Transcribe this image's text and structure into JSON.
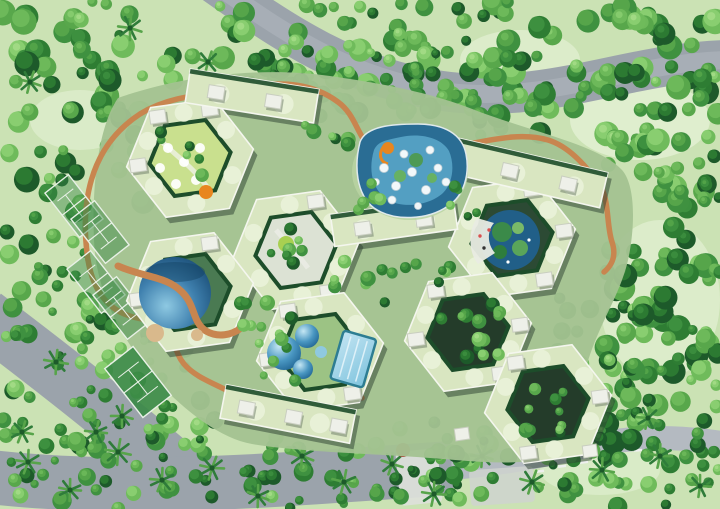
{
  "meta": {
    "description": "Aerial master-plan rendering of a hexagonal honeycomb residential complex surrounded by forest, roads, pools and tennis courts",
    "canvas": {
      "width": 720,
      "height": 509
    }
  },
  "palette": {
    "grass": "#cbe2b4",
    "glade": "#e7f3d9",
    "road": "#9ba3ab",
    "road_light": "#b4bac1",
    "plaza": "#dde1da",
    "plaza2": "#cfd4cf",
    "marking": "#eef0ee",
    "complex_ground": "#a3c291",
    "roof": "#d9e6c1",
    "roof_circle": "#e9f1d8",
    "roof_edge": "#f4f6ee",
    "box_white": "#eef0e9",
    "hedge": "#1d4d2a",
    "bldg_shadow": "#2a3e2f",
    "courtyard_dark": "#243c2a",
    "path_orange": "#c8854f",
    "deck_tan": "#d9b98c",
    "waterpark": "#2a6d94",
    "splash": "#5aa8ca",
    "slide_orange": "#e8861f",
    "lagoon": "#215f88",
    "pool_dark": "#1f5a84",
    "pool_mid": "#4a97c2",
    "pool_light": "#a2d8ec",
    "island_green": "#4e9a55",
    "island_green2": "#67b163",
    "lime_lawn": "#c9e08e",
    "paved": "#dce2d4",
    "court_green": "#3a8a46",
    "court_line": "#e8f0e6",
    "palm": "#2f7c3a",
    "palm_light": "#57a44a",
    "red_tree": "#a8503c",
    "tree_greens": [
      "#1d5a2a",
      "#2e7d33",
      "#3f9140",
      "#58a74b",
      "#6fbb5b",
      "#8bcf72",
      "#a8dd8a"
    ]
  },
  "scene": {
    "seed": 7,
    "hexR": 64,
    "hexr": 41,
    "hexes": [
      {
        "x": 190,
        "y": 158,
        "rot": -8,
        "c": "#c9e08e",
        "b": [
          240,
          300,
          180
        ]
      },
      {
        "x": 296,
        "y": 250,
        "rot": -8,
        "c": "#dce2d4",
        "b": [
          300,
          60
        ]
      },
      {
        "x": 190,
        "y": 292,
        "rot": -8,
        "c": "#4a7a52",
        "b": [
          300,
          180
        ]
      },
      {
        "x": 512,
        "y": 238,
        "rot": -8,
        "c": "#2c4a34",
        "b": [
          0,
          60,
          300
        ]
      },
      {
        "x": 320,
        "y": 352,
        "rot": -8,
        "c": "#9cc384",
        "b": [
          180,
          240,
          60
        ]
      },
      {
        "x": 468,
        "y": 332,
        "rot": -8,
        "c": "dark",
        "b": [
          180,
          240,
          60,
          0
        ]
      },
      {
        "x": 548,
        "y": 404,
        "rot": -8,
        "c": "dark",
        "b": [
          240,
          0,
          120
        ]
      }
    ],
    "bars": [
      {
        "x": 252,
        "y": 96,
        "w": 130,
        "h": 34,
        "rot": 9,
        "b": [
          -36,
          22
        ]
      },
      {
        "x": 516,
        "y": 170,
        "w": 180,
        "h": 36,
        "rot": 13,
        "b": [
          -62,
          -6,
          54
        ]
      },
      {
        "x": 394,
        "y": 222,
        "w": 124,
        "h": 32,
        "rot": -8,
        "b": [
          -32,
          30
        ]
      },
      {
        "x": 288,
        "y": 414,
        "w": 132,
        "h": 34,
        "rot": 11,
        "b": [
          -42,
          6,
          52
        ]
      }
    ],
    "courts": [
      {
        "x": 74,
        "y": 206,
        "w": 30,
        "h": 56,
        "rot": -38,
        "solid": false
      },
      {
        "x": 100,
        "y": 232,
        "w": 30,
        "h": 56,
        "rot": -38,
        "solid": false
      },
      {
        "x": 96,
        "y": 282,
        "w": 30,
        "h": 56,
        "rot": -38,
        "solid": false
      },
      {
        "x": 122,
        "y": 308,
        "w": 30,
        "h": 56,
        "rot": -38,
        "solid": false
      },
      {
        "x": 138,
        "y": 382,
        "w": 36,
        "h": 62,
        "rot": -38,
        "solid": true
      }
    ],
    "forest": [
      {
        "x": 0,
        "y": 0,
        "w": 250,
        "h": 205,
        "n": 95,
        "r0": 5,
        "r1": 13
      },
      {
        "x": 230,
        "y": 0,
        "w": 255,
        "h": 118,
        "n": 68,
        "r0": 5,
        "r1": 12
      },
      {
        "x": 468,
        "y": 0,
        "w": 252,
        "h": 150,
        "n": 80,
        "r0": 5,
        "r1": 13
      },
      {
        "x": 602,
        "y": 130,
        "w": 118,
        "h": 330,
        "n": 85,
        "r0": 5,
        "r1": 13
      },
      {
        "x": 556,
        "y": 296,
        "w": 164,
        "h": 150,
        "n": 52,
        "r0": 5,
        "r1": 12
      },
      {
        "x": 0,
        "y": 150,
        "w": 92,
        "h": 300,
        "n": 46,
        "r0": 4,
        "r1": 11
      },
      {
        "x": 78,
        "y": 318,
        "w": 125,
        "h": 140,
        "n": 36,
        "r0": 4,
        "r1": 10
      },
      {
        "x": 0,
        "y": 418,
        "w": 462,
        "h": 91,
        "n": 82,
        "r0": 4,
        "r1": 10
      },
      {
        "x": 428,
        "y": 428,
        "w": 292,
        "h": 81,
        "n": 46,
        "r0": 4,
        "r1": 10
      },
      {
        "x": 250,
        "y": 52,
        "w": 205,
        "h": 52,
        "n": 26,
        "r0": 4,
        "r1": 9
      }
    ],
    "inner_forest": [
      {
        "x": 270,
        "y": 226,
        "w": 54,
        "h": 48,
        "n": 7,
        "r0": 4,
        "r1": 8
      },
      {
        "x": 438,
        "y": 304,
        "w": 62,
        "h": 54,
        "n": 14,
        "r0": 4,
        "r1": 8
      },
      {
        "x": 518,
        "y": 384,
        "w": 58,
        "h": 50,
        "n": 10,
        "r0": 4,
        "r1": 8
      },
      {
        "x": 234,
        "y": 286,
        "w": 62,
        "h": 50,
        "n": 8,
        "r0": 4,
        "r1": 8
      },
      {
        "x": 334,
        "y": 258,
        "w": 62,
        "h": 46,
        "n": 8,
        "r0": 4,
        "r1": 8
      },
      {
        "x": 404,
        "y": 244,
        "w": 46,
        "h": 40,
        "n": 6,
        "r0": 4,
        "r1": 7
      },
      {
        "x": 352,
        "y": 182,
        "w": 34,
        "h": 38,
        "n": 5,
        "r0": 4,
        "r1": 7
      },
      {
        "x": 446,
        "y": 186,
        "w": 36,
        "h": 34,
        "n": 5,
        "r0": 4,
        "r1": 7
      },
      {
        "x": 298,
        "y": 118,
        "w": 52,
        "h": 40,
        "n": 6,
        "r0": 4,
        "r1": 8
      },
      {
        "x": 158,
        "y": 128,
        "w": 62,
        "h": 58,
        "n": 6,
        "r0": 4,
        "r1": 7
      },
      {
        "x": 258,
        "y": 330,
        "w": 42,
        "h": 54,
        "n": 6,
        "r0": 4,
        "r1": 7
      }
    ],
    "palms": [
      [
        28,
        462,
        12
      ],
      [
        70,
        490,
        11
      ],
      [
        118,
        452,
        13
      ],
      [
        162,
        480,
        12
      ],
      [
        212,
        468,
        12
      ],
      [
        258,
        496,
        11
      ],
      [
        302,
        456,
        12
      ],
      [
        344,
        482,
        12
      ],
      [
        392,
        464,
        11
      ],
      [
        434,
        494,
        12
      ],
      [
        482,
        456,
        11
      ],
      [
        532,
        482,
        12
      ],
      [
        602,
        470,
        12
      ],
      [
        660,
        456,
        12
      ],
      [
        700,
        486,
        11
      ],
      [
        22,
        432,
        11
      ],
      [
        96,
        432,
        11
      ],
      [
        56,
        362,
        12
      ],
      [
        122,
        416,
        11
      ],
      [
        30,
        82,
        11
      ],
      [
        130,
        28,
        12
      ],
      [
        208,
        62,
        11
      ],
      [
        648,
        418,
        11
      ]
    ],
    "waterpark_umbrellas": [
      [
        384,
        168,
        4.5
      ],
      [
        396,
        186,
        4.5
      ],
      [
        412,
        172,
        4.5
      ],
      [
        426,
        190,
        4.5
      ],
      [
        438,
        168,
        4
      ],
      [
        404,
        154,
        4
      ],
      [
        392,
        200,
        4
      ],
      [
        430,
        150,
        4
      ],
      [
        446,
        182,
        4
      ],
      [
        418,
        206,
        3.5
      ],
      [
        376,
        182,
        3.5
      ]
    ]
  }
}
